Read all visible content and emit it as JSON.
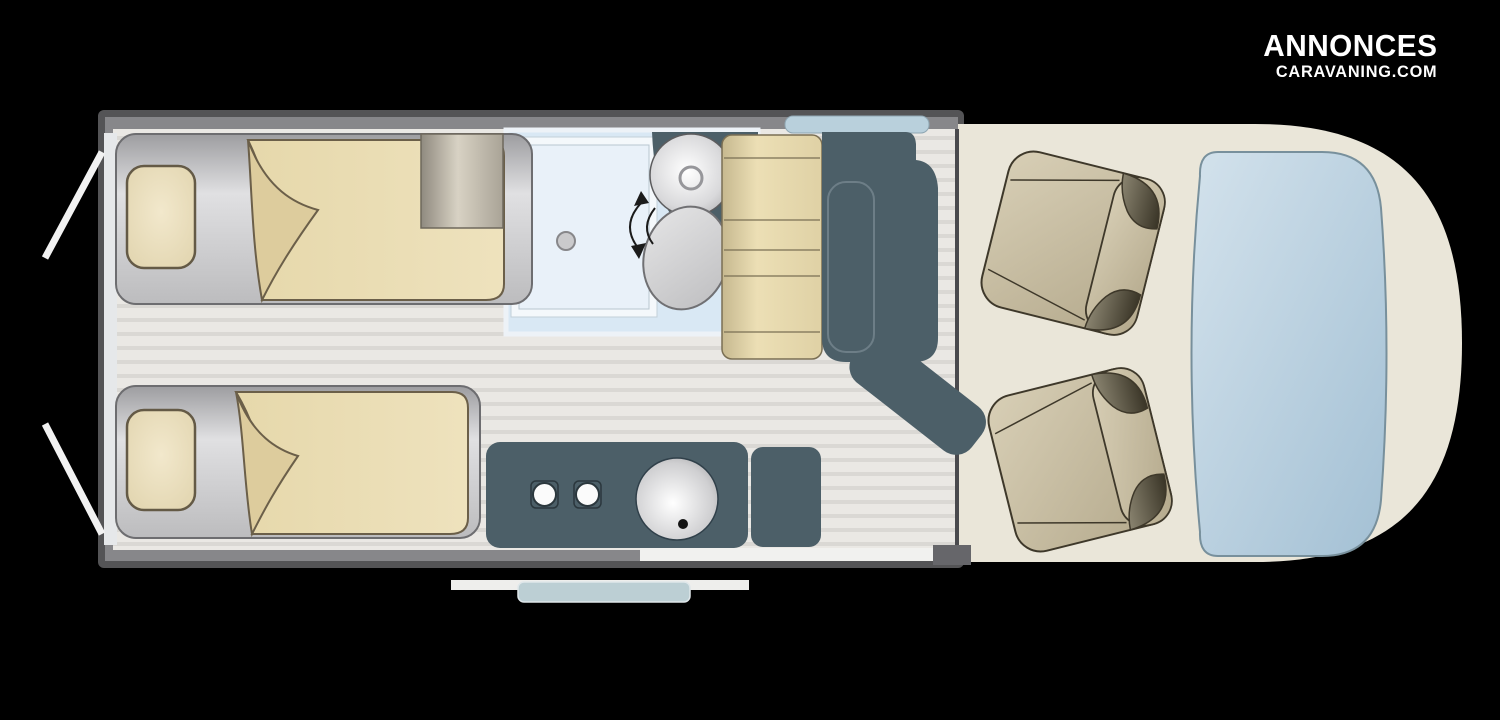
{
  "brand": {
    "line1": "ANNONCES",
    "line2": "CARAVANING.COM"
  },
  "floorplan": {
    "type": "campervan-top-view-layout",
    "elements": [
      "rear-door-left-open",
      "rear-door-right-open",
      "single-bed-top",
      "single-bed-bottom",
      "pillow",
      "folded-blanket",
      "wardrobe",
      "shower-tray",
      "shower-drain",
      "washbasin",
      "toilet",
      "swivel-arrow",
      "dinette-bench",
      "dinette-table",
      "side-window",
      "kitchen-counter",
      "hob-burners",
      "kitchen-sink",
      "cabinet",
      "entry-doorway",
      "entry-step",
      "cab-seat-top",
      "cab-seat-bottom",
      "dashboard-windshield",
      "cab-floor"
    ],
    "colors": {
      "background": "#000000",
      "body_frame": "#545456",
      "floor": "#eae8e4",
      "floor_stripe": "#dad8d4",
      "bathroom_floor": "#d9e8f4",
      "shower": "#e9f1f9",
      "counter_slate": "#4c5f68",
      "upholstery_beige": "#ecdfb6",
      "mattress_grey": "#c6c6c8",
      "cab_body_cream": "#eae6d9",
      "seat_tan": "#cdc3a8",
      "windshield_blue": "#b7cfe0",
      "window_blue": "#b9d0dc",
      "step_blue": "#bccfd4",
      "logo_text": "#ffffff"
    }
  }
}
